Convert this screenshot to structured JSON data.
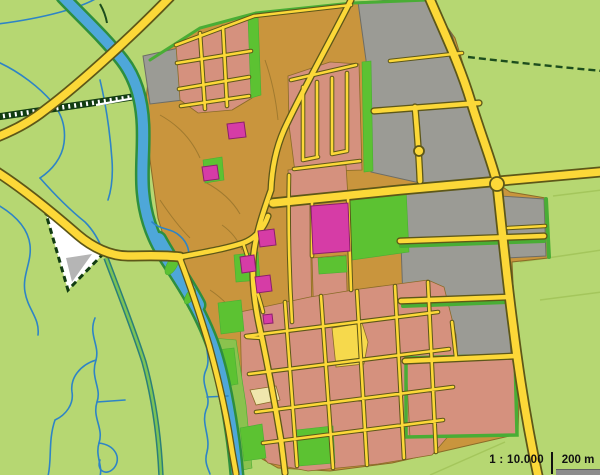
{
  "map": {
    "kind": "topographic-town-map",
    "scale": {
      "ratio_label": "1 : 10.000",
      "bar_label": "200 m"
    }
  },
  "colors": {
    "countryside": "#b6d772",
    "field_line": "#a4c65c",
    "mid_green": "#8ac24e",
    "park_green": "#5cc232",
    "strip_green": "#49ad35",
    "bank_green": "#2e8f3e",
    "river_blue": "#4ea7d9",
    "stream_blue": "#2e84c6",
    "urban_tan": "#c9953d",
    "residential_pink": "#d5917e",
    "industrial_gray": "#9b9b95",
    "industrial_border": "#6d6d66",
    "road_yellow": "#fcd838",
    "road_casing": "#5d5718",
    "lane_edge": "#2a7f7a",
    "lane_fill": "#7cc355",
    "rail_dark": "#123c12",
    "rail_tick": "#ffffff",
    "hedge_dark": "#1d4d1d",
    "building_magenta": "#d63ca6",
    "building_border": "#8a1f6b",
    "sports_yellow": "#f6d94c",
    "sand_cream": "#efe6ad",
    "parcel_outline": "#8a6b28",
    "triangle_fill": "#ffffff",
    "triangle_shadow": "#b5b5b5",
    "scale_text": "#111111",
    "scale_bar_fill": "#8d8d8d"
  }
}
